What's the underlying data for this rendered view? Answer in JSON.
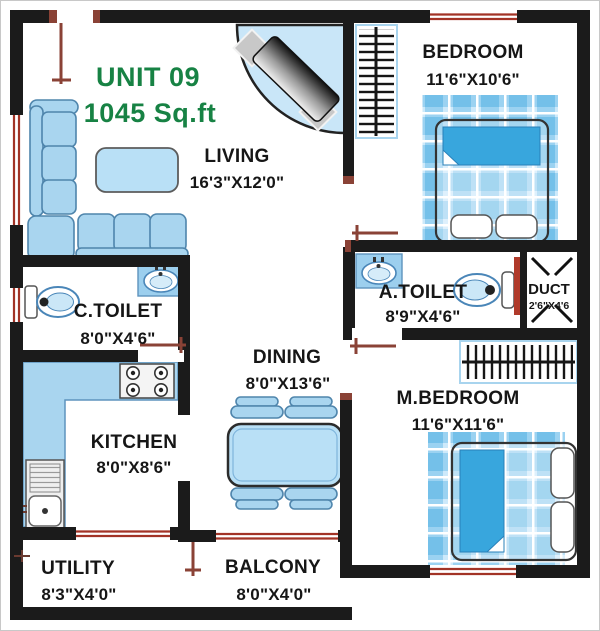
{
  "title": {
    "unit": "UNIT 09",
    "area": "1045 Sq.ft"
  },
  "rooms": {
    "living": {
      "name": "LIVING",
      "dims": "16'3\"X12'0\""
    },
    "bedroom": {
      "name": "BEDROOM",
      "dims": "11'6\"X10'6\""
    },
    "c_toilet": {
      "name": "C.TOILET",
      "dims": "8'0\"X4'6\""
    },
    "a_toilet": {
      "name": "A.TOILET",
      "dims": "8'9\"X4'6\""
    },
    "duct": {
      "name": "DUCT",
      "dims": "2'6\"X4'6"
    },
    "dining": {
      "name": "DINING",
      "dims": "8'0\"X13'6\""
    },
    "m_bedroom": {
      "name": "M.BEDROOM",
      "dims": "11'6\"X11'6\""
    },
    "kitchen": {
      "name": "KITCHEN",
      "dims": "8'0\"X8'6\""
    },
    "utility": {
      "name": "UTILITY",
      "dims": "8'3\"X4'0\""
    },
    "balcony": {
      "name": "BALCONY",
      "dims": "8'0\"X4'0\""
    }
  },
  "colors": {
    "wall": "#1b1b1b",
    "furniture_blue": "#A9D5EF",
    "blanket_blue": "#38A6DD",
    "window_red": "#A23326",
    "door_brown": "#8A4236",
    "title_green": "#178244"
  }
}
